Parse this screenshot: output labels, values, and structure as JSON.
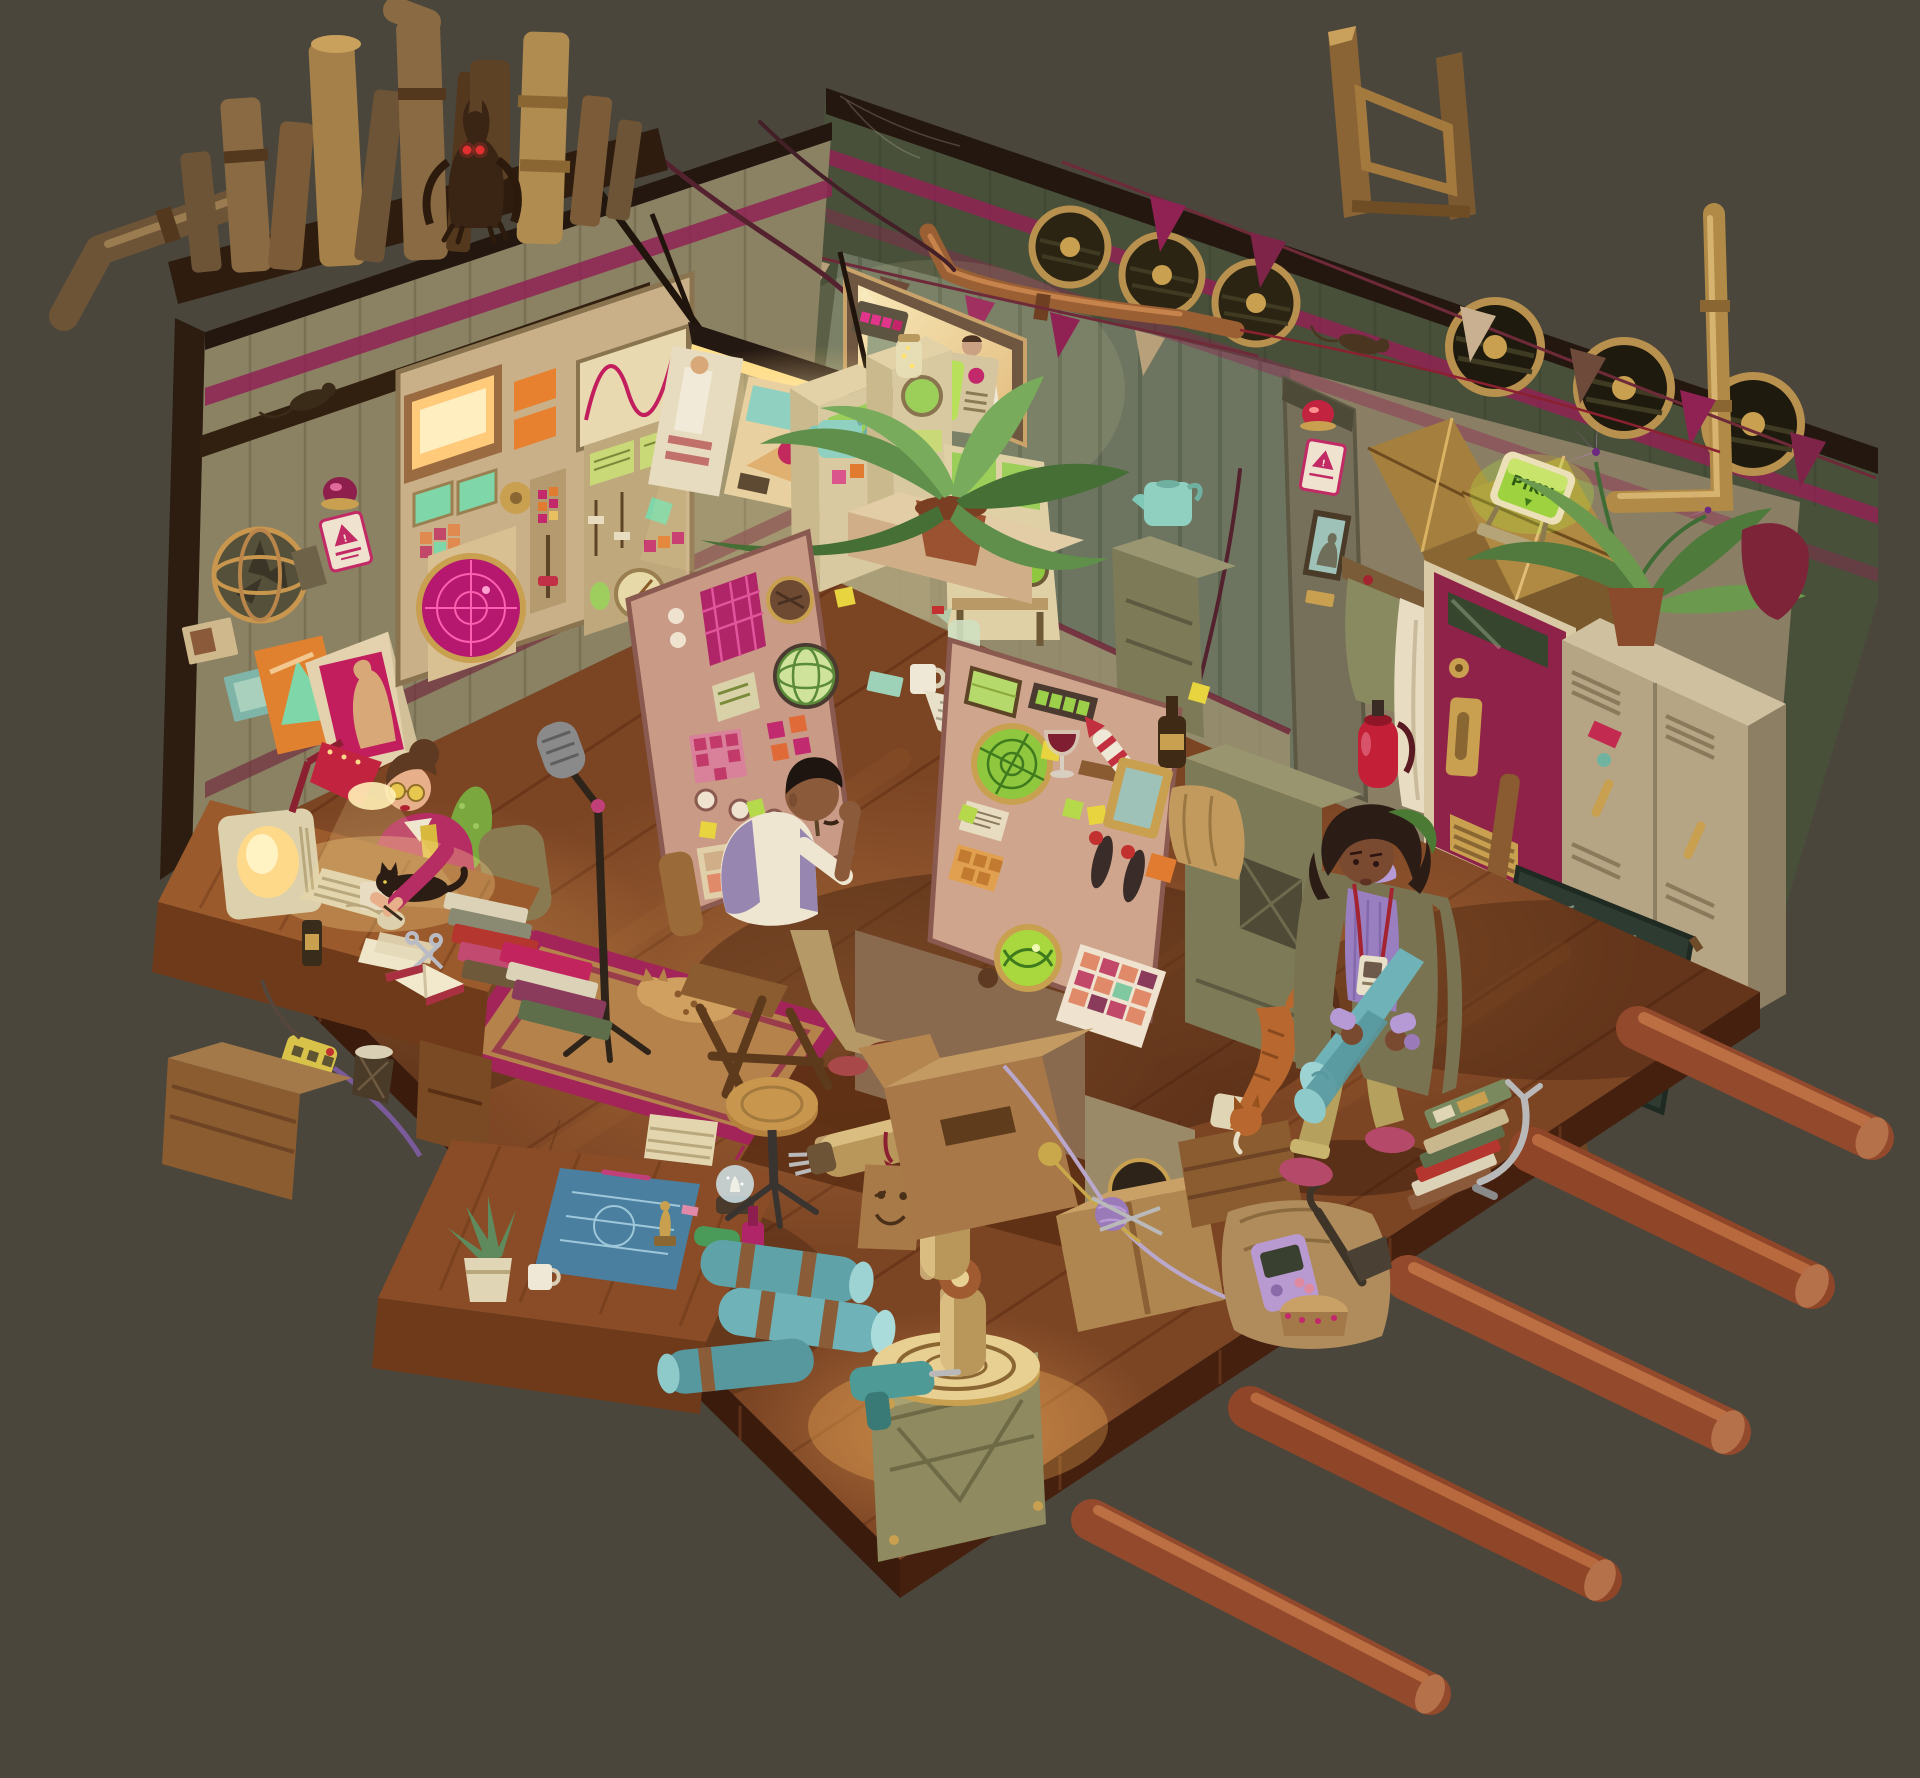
{
  "artwork": {
    "type": "digital illustration",
    "subject": "Isometric cutaway of a cluttered retro-futuristic control room workshop at night",
    "background_color": "#4a463c"
  },
  "palette": {
    "background": "#4a463c",
    "floor_wood": "#7b4423",
    "left_wall": "#8b8163",
    "right_wall_dark": "#49503a",
    "right_wall_panel": "#767a5e",
    "accent_magenta": "#8f2253",
    "accent_pink": "#d9558b",
    "accent_orange": "#e07b2f",
    "accent_teal": "#7fd6a8",
    "crt_green": "#a8d860",
    "radar_magenta": "#c81e78",
    "brass": "#b9965a",
    "copper": "#9a5f33",
    "door_crimson": "#8e2248",
    "lockers_beige": "#b5a584",
    "blueprint_teal": "#5fa3a8",
    "lamp_glow": "#ffe9a8",
    "log_wood": "#93492c"
  },
  "signs": {
    "door_sign_text": "PIKN",
    "door_sign_arrow": "▼",
    "warning_glyph": "!"
  },
  "characters": [
    {
      "id": "writer-woman",
      "desc": "woman with hair bun and yellow glasses writing at a wooden desk under a red lamp"
    },
    {
      "id": "operator-man",
      "desc": "man in lavender vest seated at the central V-shaped control console, hand on cheek"
    },
    {
      "id": "standing-woman",
      "desc": "woman in olive coat and purple turtleneck holding rolled teal blueprints, ID lanyard"
    },
    {
      "id": "window-figures",
      "desc": "two colleagues visible behind a warm observation window"
    }
  ],
  "creatures": [
    {
      "id": "gargoyle",
      "desc": "bat-like gargoyle with glowing red eyes crouching among rooftop pipes"
    },
    {
      "id": "beam-rat",
      "desc": "rat on the wall beam"
    },
    {
      "id": "wire-rat",
      "desc": "rat running along a banner wire"
    },
    {
      "id": "spotted-cat",
      "desc": "spotted cat sleeping on the rug"
    },
    {
      "id": "black-cat",
      "desc": "black cat lying on the writer's desk"
    },
    {
      "id": "orange-cat",
      "desc": "orange cat climbing down from the console platform"
    }
  ],
  "props": [
    "rooftop pipe cluster",
    "antenna frame",
    "pennant banners",
    "round wall vents",
    "control panel wall",
    "magenta radar screen",
    "sine wave display",
    "orange CRT",
    "alarm dome light",
    "warning sign",
    "armillary wall fan",
    "pin-up poster",
    "photo prints",
    "observation window",
    "green CRT television",
    "indicator box",
    "copper wall pipes",
    "hanging work lamp",
    "wall pillar with portrait",
    "brass air ducts",
    "glowing green door sign",
    "coat rack with robe",
    "fire extinguisher",
    "crimson door",
    "metal lockers",
    "potted plant with purple lilies",
    "red bag",
    "chalkboard on easel",
    "slot-machine consoles",
    "teal watering can",
    "firefly jar",
    "main control console",
    "oscilloscope screens",
    "sticky notes",
    "console plant",
    "spray bottle",
    "coffee mug",
    "newspaper",
    "wine glass",
    "model rocket",
    "beer bottle",
    "picture frame",
    "paper bag",
    "microphone boom stand",
    "pickle balloon",
    "desk monitor",
    "red desk lamp",
    "keyboard",
    "mouse",
    "scissors",
    "open book",
    "book stacks",
    "power strip",
    "waste basket",
    "wooden crate",
    "blueprint table",
    "rolled blueprints",
    "snow globe",
    "trophy figurine",
    "stool",
    "agave pot plant",
    "brass robot arm",
    "robot pedestal",
    "power drill",
    "smiley cardboard tag",
    "cardboard boxes",
    "yarn balls",
    "umbrella",
    "purple handheld console",
    "magazine stack with clamp lamp",
    "foundation logs",
    "striped rug"
  ]
}
